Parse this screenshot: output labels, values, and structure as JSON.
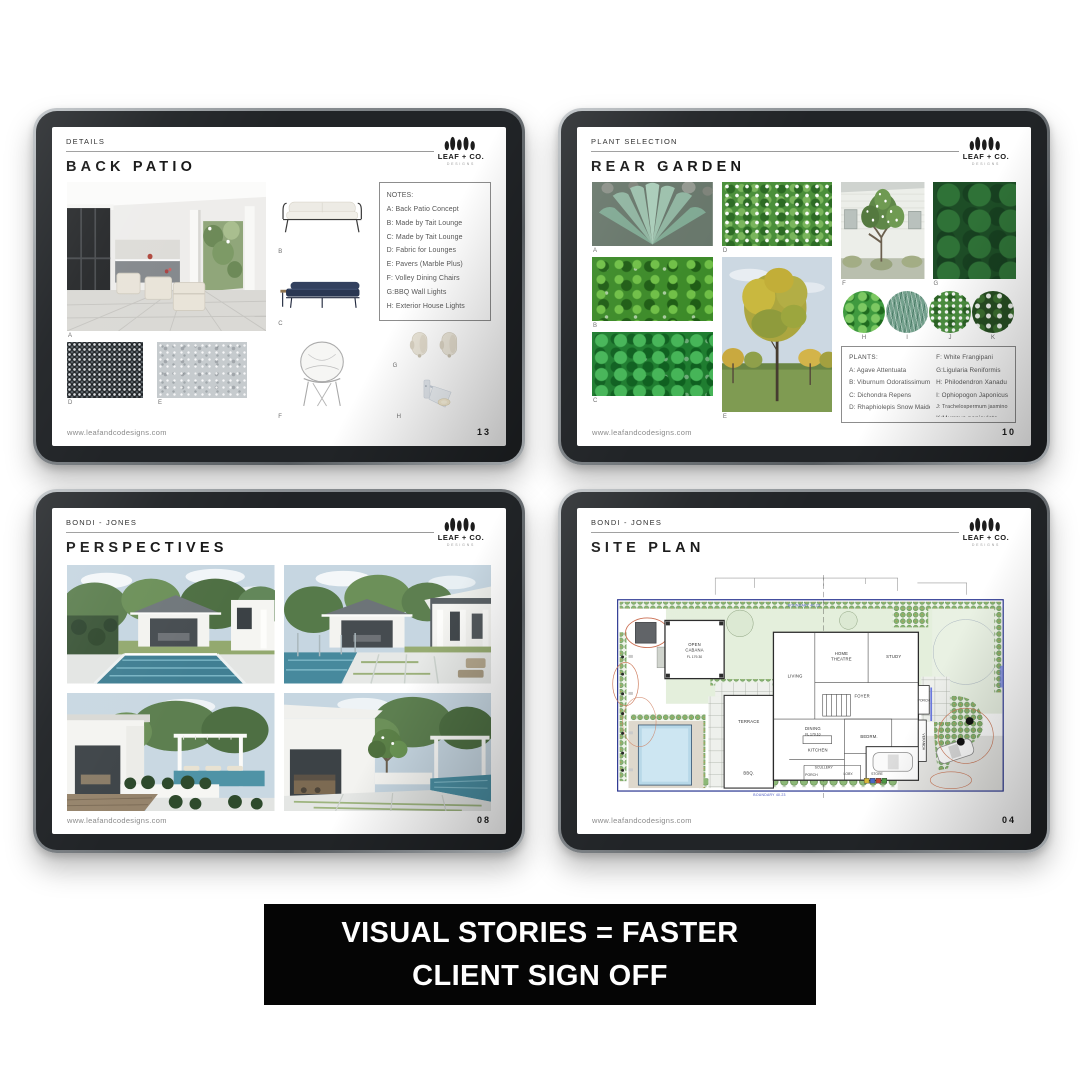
{
  "brand": {
    "name": "LEAF + CO.",
    "tagline": "DESIGNS",
    "url": "www.leafandcodesigns.com"
  },
  "banner": {
    "line1": "VISUAL STORIES = FASTER",
    "line2": "CLIENT SIGN OFF"
  },
  "slide_details": {
    "eyebrow": "DETAILS",
    "title": "BACK PATIO",
    "page": "13",
    "notes_title": "NOTES:",
    "notes": [
      "A: Back Patio Concept",
      "B: Made by Tait Lounge",
      "C: Made by Tait Lounge",
      "D: Fabric for Lounges",
      "E: Pavers (Marble Plus)",
      "F: Volley Dining Chairs",
      "G:BBQ Wall Lights",
      "H: Exterior House Lights"
    ],
    "labels": [
      "A",
      "B",
      "C",
      "D",
      "E",
      "F",
      "G",
      "H"
    ]
  },
  "slide_plants": {
    "eyebrow": "PLANT SELECTION",
    "title": "REAR GARDEN",
    "page": "10",
    "plants_title": "PLANTS:",
    "plants_col1": [
      "A: Agave Attentuata",
      "B: Viburnum Odoratissimum",
      "C: Dichondra Repens",
      "D: Rhaphiolepis Snow Maiden",
      "E: Ginko Biloba"
    ],
    "plants_col2": [
      "F: White Frangipani",
      "G:Ligularia Reniformis",
      "H: Philodendron Xanadu",
      "I: Ophiopogon Japonicus",
      "J: Trachelospermum jasminoides",
      "K:Murraya paniculata"
    ],
    "labels": [
      "A",
      "B",
      "C",
      "D",
      "E",
      "F",
      "G",
      "H",
      "I",
      "J",
      "K"
    ]
  },
  "slide_perspectives": {
    "eyebrow": "BONDI - JONES",
    "title": "PERSPECTIVES",
    "page": "08"
  },
  "slide_siteplan": {
    "eyebrow": "BONDI - JONES",
    "title": "SITE PLAN",
    "page": "04",
    "rooms": {
      "cabana1": "OPEN",
      "cabana2": "CABANA",
      "cabana_fl": "FL 179.30",
      "living": "LIVING",
      "theatre1": "HOME",
      "theatre2": "THEATRE",
      "study": "STUDY",
      "foyer": "FOYER",
      "porch_r": "PORCH",
      "veranda": "VERANDA",
      "terrace": "TERRACE",
      "dining": "DINING",
      "dining_fl": "FL 179.10",
      "bedrm": "BEDRM.",
      "kitchen": "KITCHEN",
      "scullery": "SCULLERY",
      "bbq": "BBQ.",
      "lobby": "LOBY.",
      "store": "STORE",
      "porch_b": "PORCH",
      "boundary_top": "BOUNDARY 40.23",
      "boundary_bottom": "BOUNDARY 40.23"
    }
  }
}
